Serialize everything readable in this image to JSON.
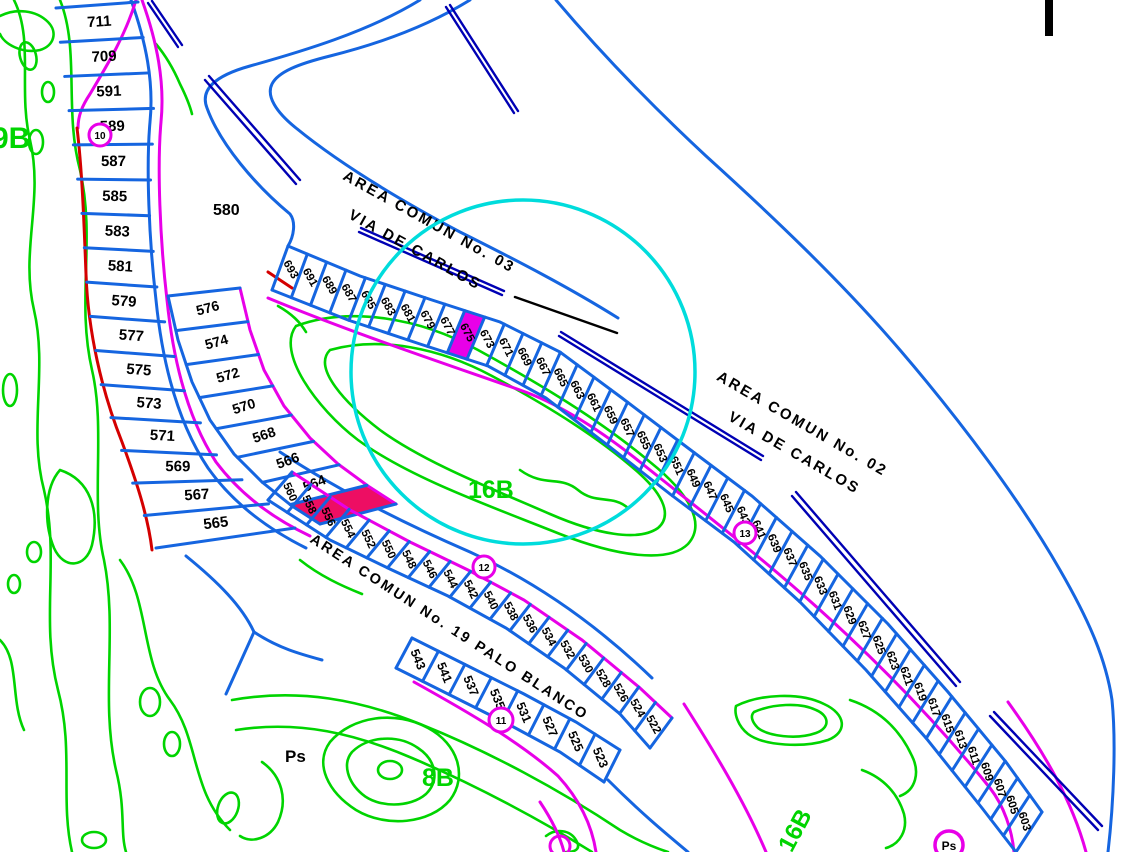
{
  "palette": {
    "background": "#FFFFFF",
    "parcel_blue": "#1565E0",
    "median_navy": "#0000B4",
    "road_magenta": "#E800E8",
    "boundary_red": "#D40000",
    "golf_green": "#00D400",
    "selection_cyan": "#00DCDC",
    "label_black": "#000000",
    "highlight_magenta_fill": "#E800E8",
    "highlight_red_fill": "#ED0E63",
    "highlight_number_navy": "#000082"
  },
  "canvas": {
    "width": 1136,
    "height": 852
  },
  "map": {
    "area_labels": {
      "left_course": "9B",
      "center_course": "16B",
      "bottom_course": "8B",
      "bottom_right_course": "16B",
      "open_parcel": "580",
      "ps_label": "Ps",
      "ps_marker": "Ps"
    },
    "streets": {
      "top_line1": "AREA COMUN No. 03",
      "top_line2": "VIA DE CARLOS",
      "right_line1": "AREA COMUN No. 02",
      "right_line2": "VIA DE CARLOS",
      "middle": "AREA COMUN No. 19 PALO BLANCO"
    },
    "markers": {
      "m10": "10",
      "m11": "11",
      "m12": "12",
      "m13": "13"
    },
    "strips": {
      "left_fan": [
        "711",
        "709",
        "591",
        "589",
        "587",
        "585",
        "583",
        "581",
        "579",
        "577",
        "575",
        "573",
        "571",
        "569",
        "567",
        "565"
      ],
      "inner_column": [
        "576",
        "574",
        "572",
        "570",
        "568",
        "566",
        "564",
        ""
      ],
      "via_carlos_strip": [
        "693",
        "691",
        "689",
        "687",
        "685",
        "683",
        "681",
        "679",
        "677",
        "675",
        "673",
        "671",
        "669",
        "667",
        "665",
        "663",
        "661",
        "659",
        "657",
        "655",
        "653",
        "651",
        "649",
        "647",
        "645",
        "643",
        "641",
        "639",
        "637",
        "635",
        "633",
        "631",
        "629",
        "627",
        "625",
        "623",
        "621",
        "619",
        "617",
        "615",
        "613",
        "611",
        "609",
        "607",
        "605",
        "603"
      ],
      "palo_blanco_upper": [
        "560",
        "558",
        "556",
        "554",
        "552",
        "550",
        "548",
        "546",
        "544",
        "542",
        "540",
        "538",
        "536",
        "534",
        "532",
        "530",
        "528",
        "526",
        "524",
        "522"
      ],
      "palo_blanco_lower": [
        "543",
        "541",
        "537",
        "535",
        "531",
        "527",
        "525",
        "523"
      ]
    }
  }
}
